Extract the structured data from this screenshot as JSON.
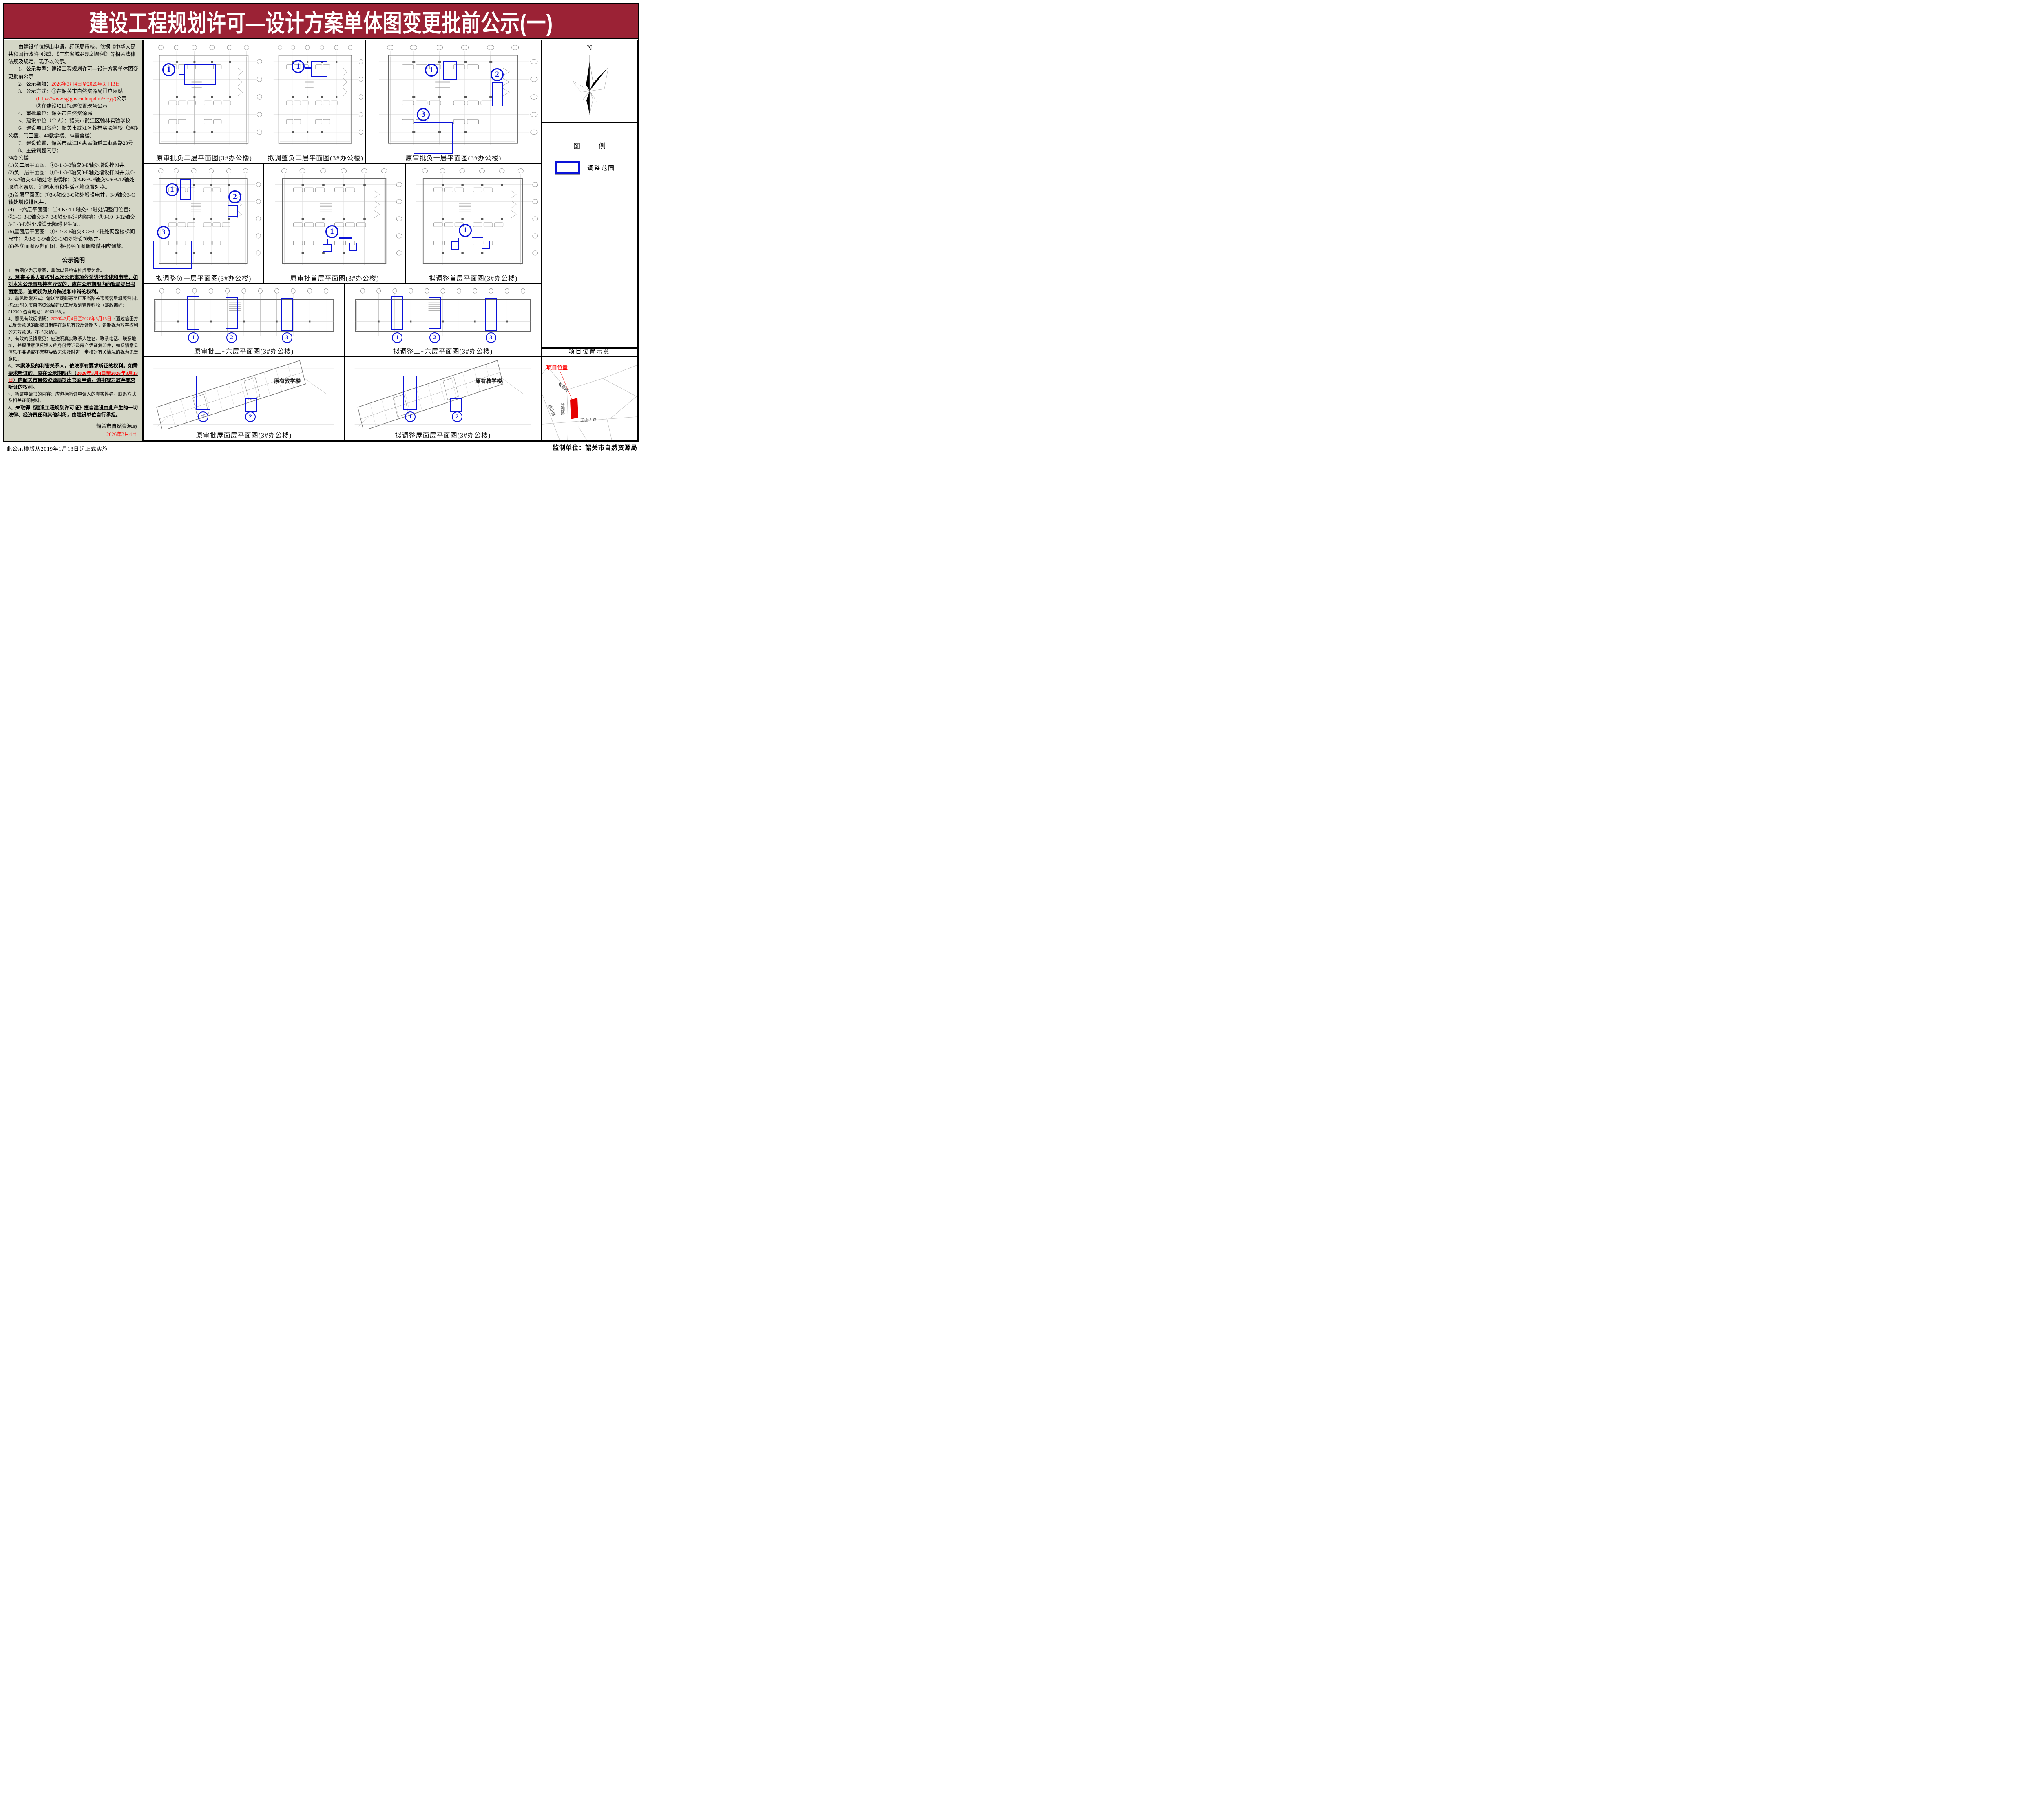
{
  "title": "建设工程规划许可—设计方案单体图变更批前公示(一)",
  "colors": {
    "banner_bg": "#9b2235",
    "banner_text": "#ffffff",
    "highlight_red": "#fe0000",
    "annotation_blue": "#0a12d8",
    "left_panel_bg": "#d4d6c6",
    "parcel_red": "#e60000"
  },
  "left": {
    "intro": "由建设单位提出申请，经我局审核，依据《中华人民共和国行政许可法》、《广东省城乡规划条例》等相关法律法规及规定，现予以公示。",
    "i1": "1、公示类型：建设工程规划许可—设计方案单体图变更批前公示",
    "i2_label": "2、公示期限：",
    "i2_value": "2026年3月4日至2026年3月13日",
    "i3": "3、公示方式：①在韶关市自然资源局门户网站",
    "i3_url": "(https://www.sg.gov.cn/bmpdlm/zrzyj/)",
    "i3_suffix": "公示",
    "i3_line2": "②在建设项目拟建位置现场公示",
    "i4": "4、审批单位：韶关市自然资源局",
    "i5": "5、建设单位（个人）：韶关市武江区翰林实验学校",
    "i6": "6、建设项目名称：韶关市武江区翰林实验学校（3#办公楼、门卫室、4#教学楼、5#宿舍楼）",
    "i7": "7、建设位置：韶关市武江区惠民街道工业西路28号",
    "i8": "8、主要调整内容：",
    "b0": "3#办公楼",
    "b1": "(1)负二层平面图：①3-1~3-3轴交3-E轴处增设排风井。",
    "b2": "(2)负一层平面图：①3-1~3-3轴交3-E轴处增设排风井;②3-5~3-7轴交3-J轴处增设楼梯；③3-B~3-F轴交3-9~3-12轴处取消水泵房、消防水池和生活水箱位置对换。",
    "b3": "(3)首层平面图：①3-6轴交3-C轴处增设电井，3-9轴交3-C轴处增设排风井。",
    "b4": "(4)二~六层平面图：①4-K~4-L轴交3-4轴处调整门位置；②3-C~3-E轴交3-7~3-8轴处取消内隔墙；③3-10~3-12轴交3-C~3-D轴处增设无障碍卫生间。",
    "b5": "(5)屋面层平面图：①3-4~3-6轴交3-C~3-E轴处调整楼梯间尺寸；②3-8~3-9轴交3-C轴处增设排烟井。",
    "b6": "(6)各立面图及剖面图：根据平面图调整做相应调整。"
  },
  "notes": {
    "heading": "公示说明",
    "n1": "1、右图仅为示意图，具体以最终审批成果为准。",
    "n2": "2、利害关系人有权对本次公示事项依法进行陈述和申辩，如对本次公示事项持有异议的，应在公示期限内向我局提出书面意见，逾期视为放弃陈述和申辩的权利。",
    "n3": "3、意见反馈方式：请送至或邮寄至广东省韶关市芙蓉新城芙蓉园1栋203韶关市自然资源局建设工程规划管理科收（邮政编码：512000,咨询电话：8963168）。",
    "n4_label": "4、意见有效反馈期：",
    "n4_red": "2026年3月4日至2026年3月13日",
    "n4_rest": "（通过信函方式反馈意见的邮戳日期应在意见有效反馈期内，逾期视为放弃权利的无效意见，不予采纳）。",
    "n5": "5、有效的反馈意见：应注明真实联系人姓名、联系电话、联系地址，并提供意见反馈人的身份凭证及房产凭证复印件，如反馈意见信息不准确或不完整导致无法及时进一步核对有关情况的视为无效意见。",
    "n6_a": "6、本案涉及的利害关系人，依法享有要求听证的权利。如需要求听证的，应在公示期限内（",
    "n6_red": "2026年3月4日至2026年3月13日",
    "n6_b": "）向韶关市自然资源局提出书面申请，逾期视为放弃要求听证的权利。",
    "n7": "7、听证申请书的内容：应包括听证申请人的真实姓名，联系方式及相关证明材料。",
    "n8": "8、未取得《建设工程规划许可证》擅自建设由此产生的一切法律、经济责任和其他纠纷，由建设单位自行承担。",
    "sign_org": "韶关市自然资源局",
    "sign_date": "2026年3月4日"
  },
  "panels": [
    {
      "caption": "原审批负二层平面图(3#办公楼)",
      "markers": [
        "1"
      ]
    },
    {
      "caption": "拟调整负二层平面图(3#办公楼)",
      "markers": [
        "1"
      ]
    },
    {
      "caption": "原审批负一层平面图(3#办公楼)",
      "markers": [
        "1",
        "2",
        "3"
      ]
    },
    {
      "caption": "拟调整负一层平面图(3#办公楼)",
      "markers": [
        "1",
        "2",
        "3"
      ]
    },
    {
      "caption": "原审批首层平面图(3#办公楼)",
      "markers": [
        "1"
      ]
    },
    {
      "caption": "拟调整首层平面图(3#办公楼)",
      "markers": [
        "1"
      ]
    },
    {
      "caption": "原审批二~六层平面图(3#办公楼)",
      "markers": [
        "1",
        "2",
        "3"
      ]
    },
    {
      "caption": "拟调整二~六层平面图(3#办公楼)",
      "markers": [
        "1",
        "2",
        "3"
      ]
    },
    {
      "caption": "原审批屋面层平面图(3#办公楼)",
      "markers": [
        "1",
        "2"
      ],
      "note": "原有教学楼"
    },
    {
      "caption": "拟调整屋面层平面图(3#办公楼)",
      "markers": [
        "1",
        "2"
      ],
      "note": "原有教学楼"
    }
  ],
  "sidebar": {
    "north_label": "N",
    "legend_title": "图　例",
    "legend_item": "调整范围",
    "location_title": "项目位置示意",
    "location_label": "项目位置",
    "roads": [
      "教育路",
      "稔山路",
      "沙湖路",
      "工业西路"
    ]
  },
  "footer": {
    "left": "此公示模版从2019年1月18日起正式实施",
    "right": "监制单位：韶关市自然资源局"
  }
}
